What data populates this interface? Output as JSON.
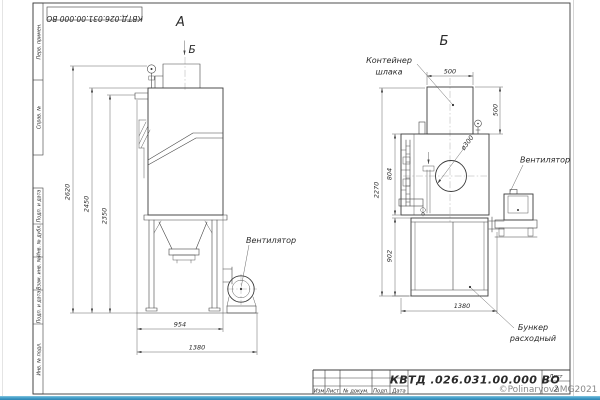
{
  "sheet": {
    "top_designation": "КВТД.026.031.00.000 ВО",
    "side_column_labels": [
      "Перв. примен.",
      "Справ. №",
      "Подп. и дата",
      "Инв. № дубл.",
      "Взам. инв. №",
      "Подп. и дата",
      "Инв. № подл."
    ],
    "watermark": "©PolinaryovaMG2021"
  },
  "title_block": {
    "designation": "КВТД .026.031.00.000 ВО",
    "footer_columns": [
      "Изм",
      "Лист",
      "№ докум.",
      "Подп.",
      "Дата"
    ],
    "sheet_label": "Лист",
    "sheet_number": "2"
  },
  "view_a": {
    "title": "А",
    "direction_label": "Б",
    "fan_label": "Вентилятор",
    "dim_total_height": "2620",
    "dim_body_height": "2450",
    "dim_inlet_height": "2350",
    "dim_body_width": "954",
    "dim_total_width": "1380"
  },
  "view_b": {
    "title": "Б",
    "container_label_line1": "Контейнер",
    "container_label_line2": "шлака",
    "fan_label": "Вентилятор",
    "hopper_label_line1": "Бункер",
    "hopper_label_line2": "расходный",
    "dim_container_width": "500",
    "dim_container_height": "500",
    "dim_hole_diameter": "ø300",
    "dim_mid_height": "804",
    "dim_total_height": "2270",
    "dim_hopper_height": "902",
    "dim_width": "1380"
  }
}
